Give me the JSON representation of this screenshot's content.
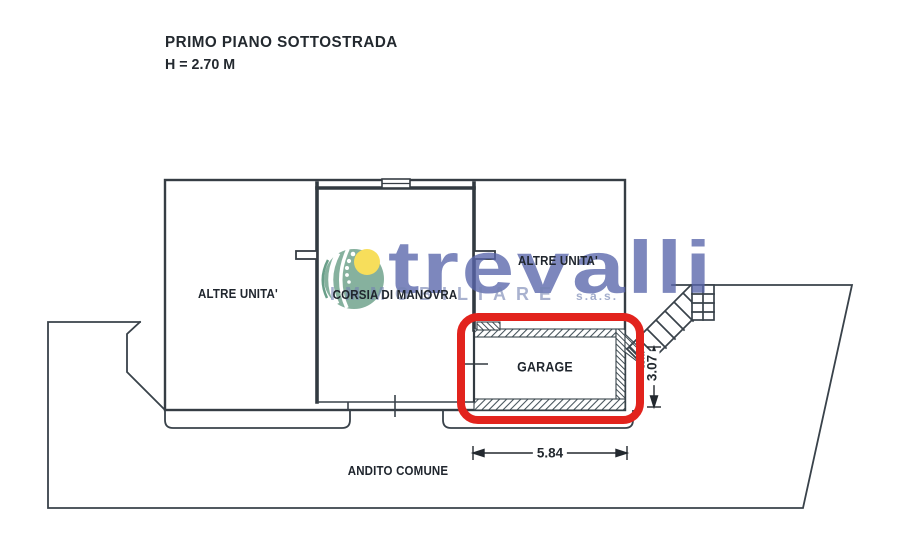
{
  "title": {
    "line1": "PRIMO PIANO SOTTOSTRADA",
    "line2": "H = 2.70 M"
  },
  "rooms": {
    "altre_unita_left": "ALTRE UNITA'",
    "corsia": "CORSIA DI MANOVRA",
    "altre_unita_right": "ALTRE UNITA'",
    "garage": "GARAGE",
    "andito": "ANDITO COMUNE"
  },
  "dimensions": {
    "garage_width": "5.84",
    "garage_depth": "3.07"
  },
  "watermark": {
    "brand": "trevalli",
    "subtitle": "IMMOBILIARE",
    "suffix": "s.a.s."
  },
  "colors": {
    "highlight_red": "#e2231d",
    "plan_line": "#39424a",
    "hatch": "#44525a",
    "watermark_blue": "#5865aa",
    "logo_green": "#7cab96",
    "logo_yellow": "#f7dc4e"
  }
}
